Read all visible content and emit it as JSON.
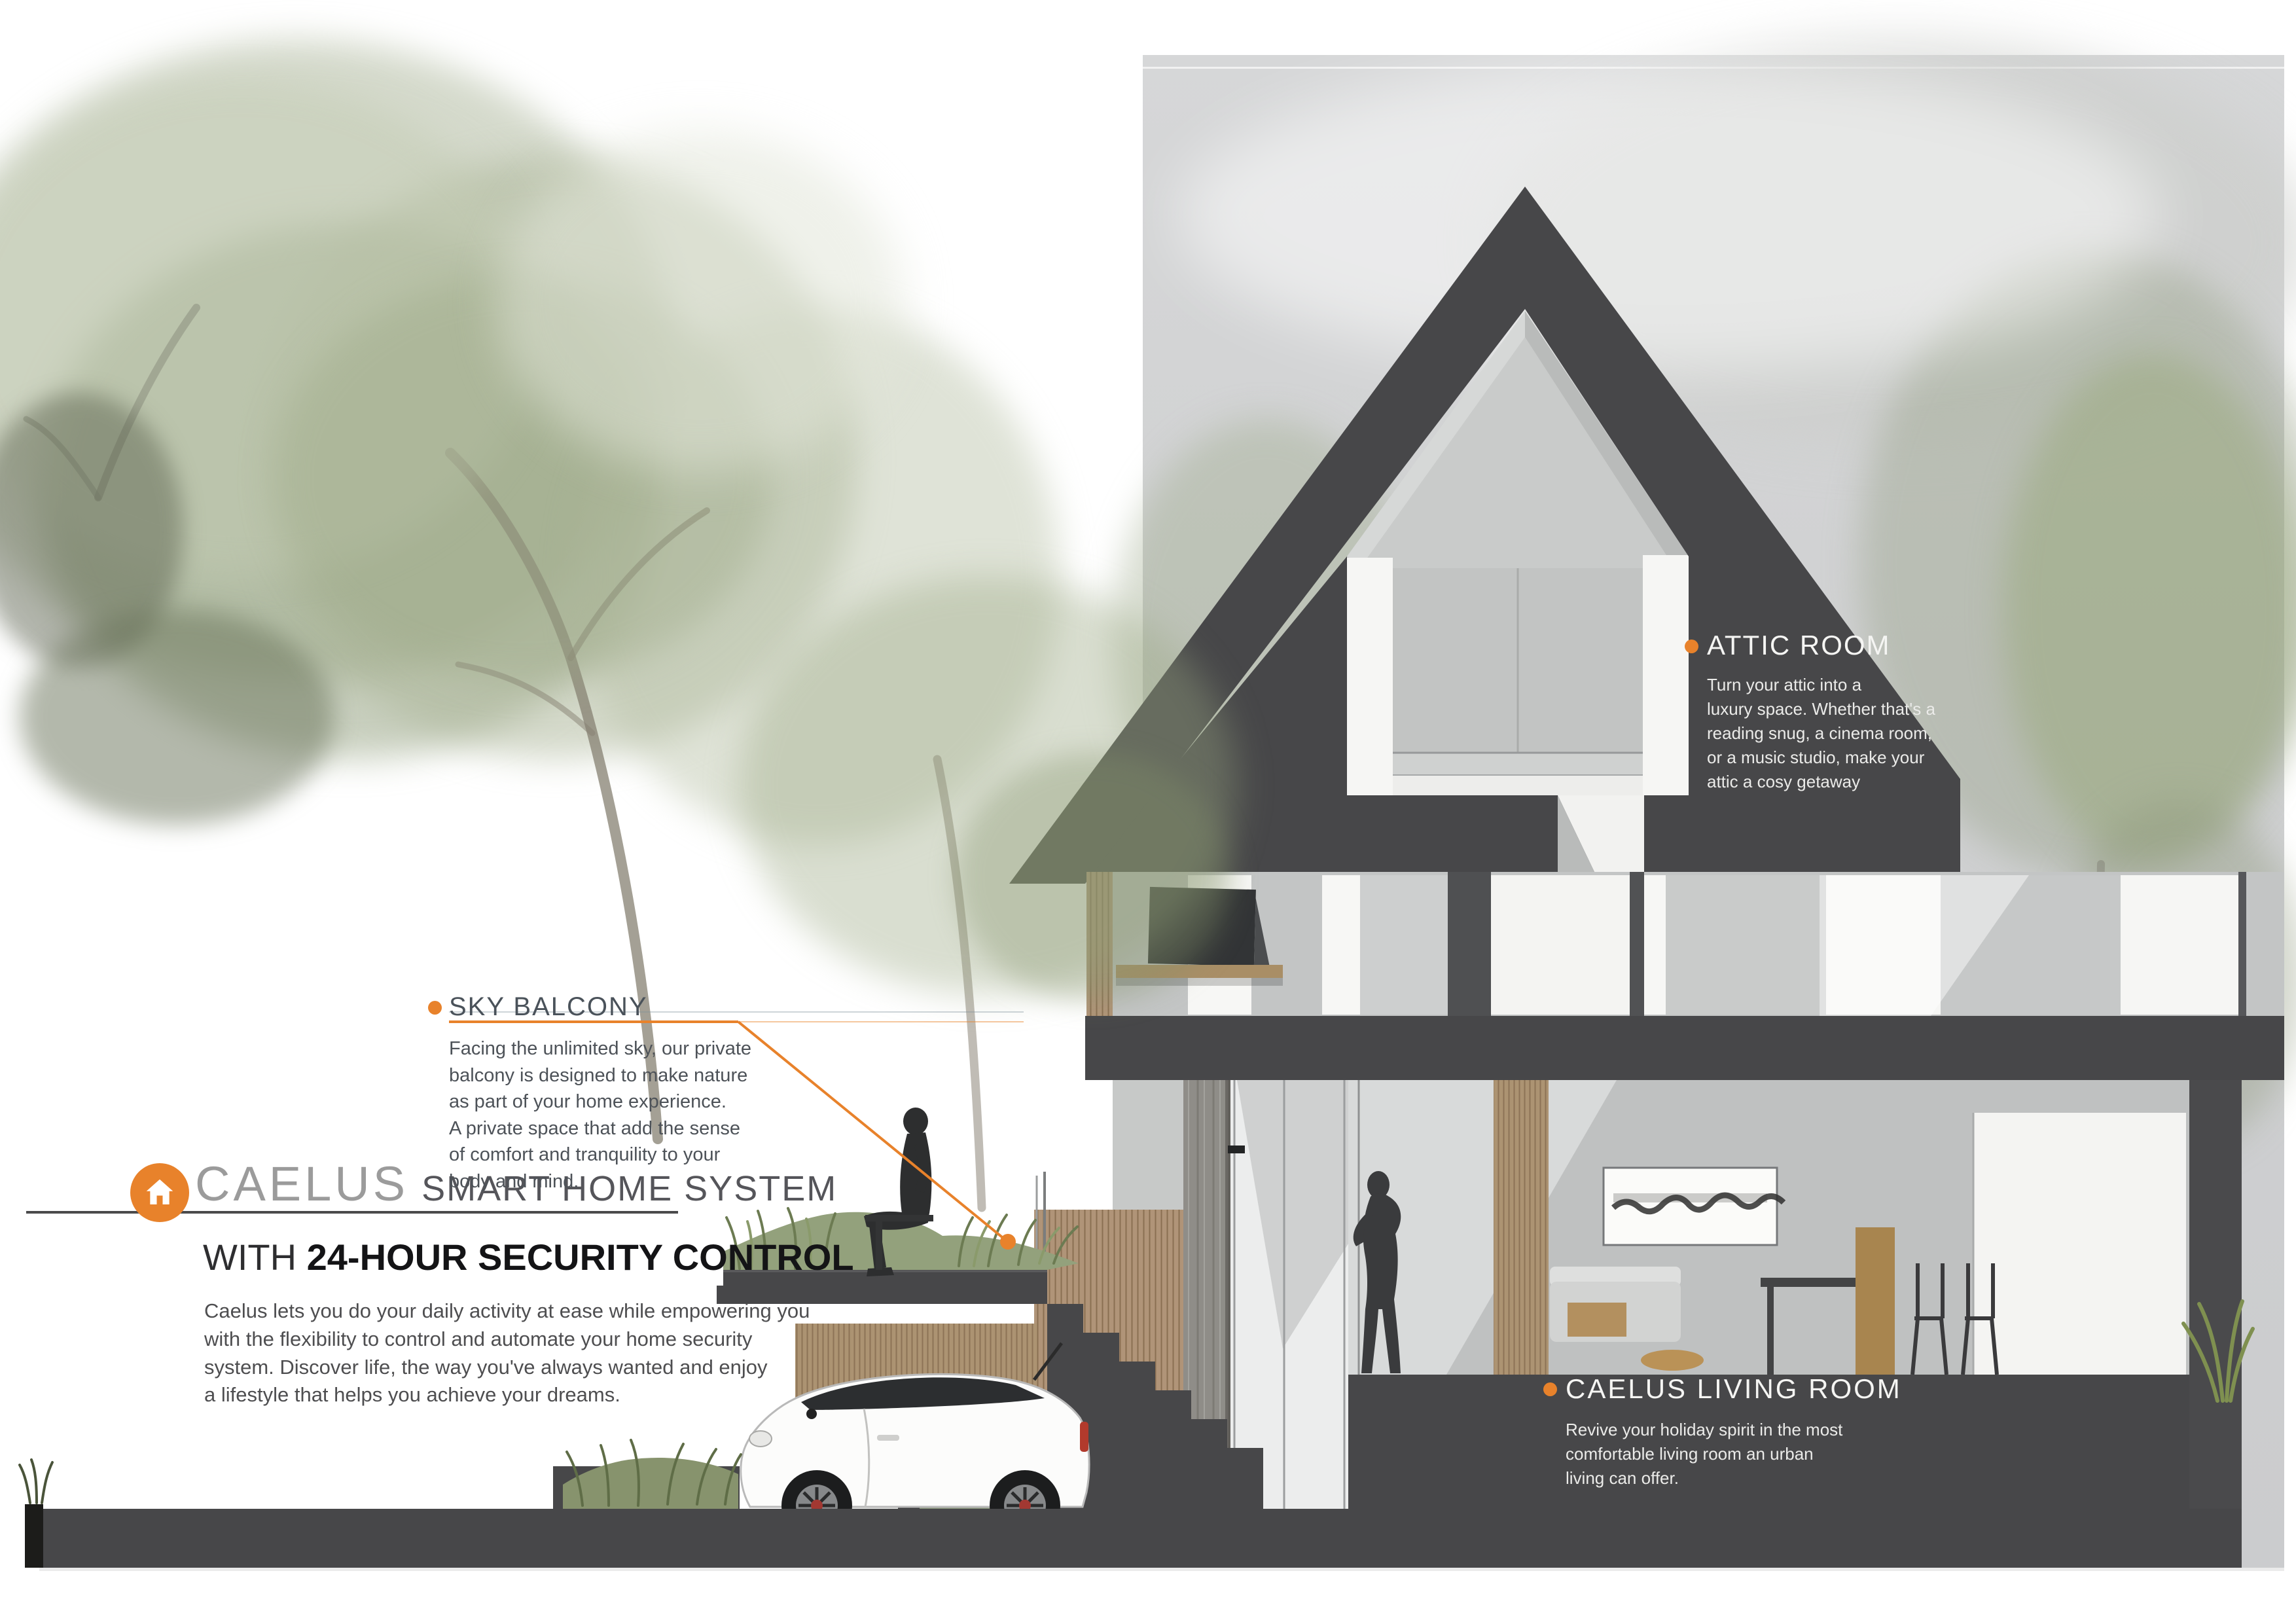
{
  "brand": {
    "logo_icon": "house-icon",
    "name": "CAELUS",
    "tagline": "SMART HOME SYSTEM",
    "subtitle_prefix": "WITH ",
    "subtitle_bold": "24-HOUR SECURITY CONTROL",
    "description": "Caelus lets you do your daily activity at ease while empowering you\nwith the flexibility to control and automate your home security\nsystem. Discover life, the way you've always wanted and enjoy\na lifestyle that helps you achieve your dreams."
  },
  "annotations": [
    {
      "id": "sky-balcony",
      "title": "SKY BALCONY",
      "body": "Facing the unlimited sky, our private\nbalcony is designed to make nature\nas part of your home experience.\nA private space that add the sense\nof comfort and tranquility to your\nbody and mind.",
      "marker": "orange-dot"
    },
    {
      "id": "attic-room",
      "title": "ATTIC ROOM",
      "body": "Turn your attic into a\nluxury space. Whether that's a\nreading snug, a cinema room,\nor a music studio, make your\nattic a cosy getaway",
      "marker": "orange-dot"
    },
    {
      "id": "caelus-living-room",
      "title": "CAELUS LIVING ROOM",
      "body": "Revive your holiday spirit in the most\ncomfortable living room an urban\nliving can offer.",
      "marker": "orange-dot"
    }
  ],
  "colors": {
    "accent_orange": "#E8822B",
    "roof_dark": "#474749",
    "band_gray": "#D2D3D4",
    "foliage_green": "#9CAB87",
    "wood_tan": "#AC9372",
    "car_body": "#FCFCFB",
    "silhouette": "#2E2F30"
  },
  "scene": {
    "type": "architectural-section",
    "rooms": [
      "attic room",
      "second floor media wall",
      "living room",
      "garage",
      "sky balcony"
    ],
    "figures": [
      "man sitting on sky balcony",
      "woman standing in living room"
    ],
    "vehicle": "white mini hatchback in garage"
  }
}
